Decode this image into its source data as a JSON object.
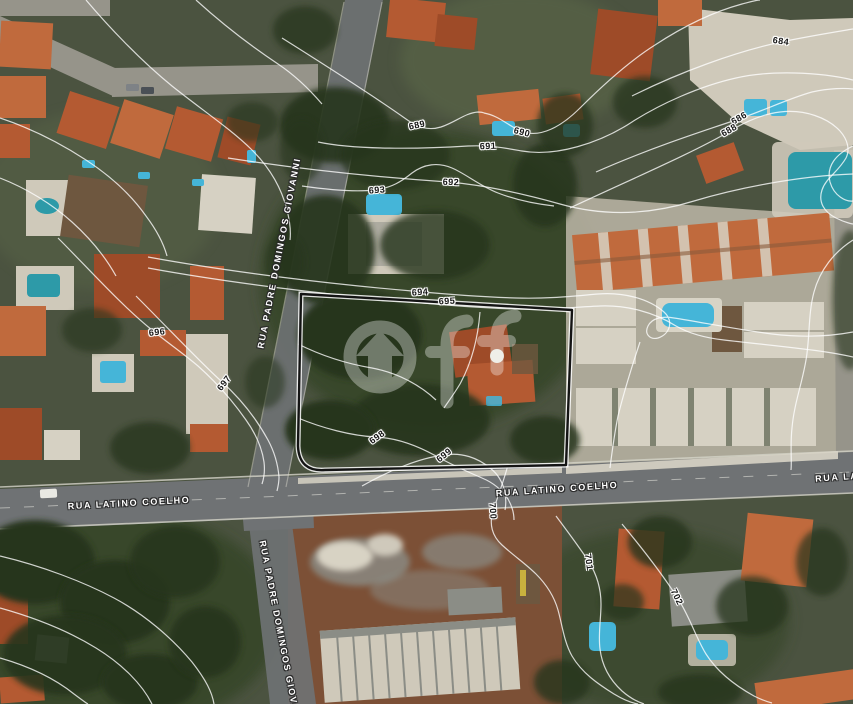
{
  "map": {
    "watermark": {
      "text": "OFF",
      "ff_text": "ff"
    },
    "street_labels": [
      {
        "id": "rua-padre-domingos-giovanni-north",
        "text": "RUA PADRE DOMINGOS GIOVANNI",
        "x": 279,
        "y": 253,
        "rotation": -79
      },
      {
        "id": "rua-padre-domingos-giovanni-south",
        "text": "RUA PADRE DOMINGOS GIOVANNI",
        "x": 281,
        "y": 636,
        "rotation": 79
      },
      {
        "id": "rua-latino-coelho-west",
        "text": "RUA LATINO COELHO",
        "x": 129,
        "y": 503,
        "rotation": -3
      },
      {
        "id": "rua-latino-coelho-east",
        "text": "RUA LATINO COELHO",
        "x": 557,
        "y": 489,
        "rotation": -4
      },
      {
        "id": "rua-latino-coelho-east-edge",
        "text": "RUA LAT",
        "x": 840,
        "y": 477,
        "rotation": -4
      }
    ],
    "contour_labels": [
      {
        "value": "684",
        "x": 781,
        "y": 41,
        "rotation": 8
      },
      {
        "value": "686",
        "x": 739,
        "y": 118,
        "rotation": -30
      },
      {
        "value": "688",
        "x": 729,
        "y": 130,
        "rotation": -30
      },
      {
        "value": "689",
        "x": 417,
        "y": 125,
        "rotation": -12
      },
      {
        "value": "690",
        "x": 522,
        "y": 132,
        "rotation": 14
      },
      {
        "value": "691",
        "x": 488,
        "y": 146,
        "rotation": -2
      },
      {
        "value": "692",
        "x": 451,
        "y": 182,
        "rotation": 2
      },
      {
        "value": "693",
        "x": 377,
        "y": 190,
        "rotation": -4
      },
      {
        "value": "694",
        "x": 420,
        "y": 292,
        "rotation": -4
      },
      {
        "value": "695",
        "x": 447,
        "y": 301,
        "rotation": -3
      },
      {
        "value": "696",
        "x": 157,
        "y": 332,
        "rotation": -6
      },
      {
        "value": "697",
        "x": 224,
        "y": 383,
        "rotation": -52
      },
      {
        "value": "698",
        "x": 377,
        "y": 437,
        "rotation": -36
      },
      {
        "value": "699",
        "x": 444,
        "y": 455,
        "rotation": -38
      },
      {
        "value": "700",
        "x": 493,
        "y": 511,
        "rotation": 86
      },
      {
        "value": "701",
        "x": 589,
        "y": 562,
        "rotation": 82
      },
      {
        "value": "702",
        "x": 677,
        "y": 597,
        "rotation": 64
      }
    ],
    "contour_lines": [
      {
        "d": "M632,96 C680,72 735,52 781,42 C810,36 835,32 853,29"
      },
      {
        "d": "M596,172 C650,148 706,130 739,119 C765,110 790,98 812,92 C830,88 845,88 853,89"
      },
      {
        "d": "M570,208 C625,182 695,152 730,131 C748,120 764,114 780,112 C805,109 828,118 840,131 C848,140 850,150 846,158 C838,172 826,178 822,190 C818,202 824,212 836,218 C846,223 853,224 853,224"
      },
      {
        "d": "M282,38 C320,62 368,92 406,119 C417,127 428,131 441,127 C456,122 465,113 478,112 C480,112 482,112 484,113"
      },
      {
        "d": "M484,113 C500,116 508,126 521,131 C540,139 562,126 580,108 C600,88 628,62 655,45 C690,22 720,10 742,4 C750,2 756,0 760,0"
      },
      {
        "d": "M318,142 C356,150 420,149 468,146 C490,145 505,148 522,151 C556,157 600,143 632,122 C660,104 700,86 736,78 C770,70 820,72 853,80"
      },
      {
        "d": "M228,158 C280,166 360,176 448,182 C486,185 524,194 560,204 C606,217 652,214 694,201 C734,189 796,176 853,174"
      },
      {
        "d": "M302,186 C330,190 356,192 374,190 C392,188 402,181 412,173 C424,164 438,162 452,168 C466,174 480,186 498,193 C516,200 536,204 554,206"
      },
      {
        "d": "M148,257 C230,272 330,284 412,291 C444,294 482,297 516,298 C548,299 574,296 598,294 C622,292 648,298 664,312 C674,321 670,334 658,338 C650,340 644,334 648,326 C652,318 662,316 674,318 C700,322 740,330 772,334 C805,338 832,336 853,332"
      },
      {
        "d": "M148,268 C230,283 330,295 412,302 C444,305 482,308 516,309 C548,310 576,307 600,306 C626,305 654,312 676,326 C690,334 706,338 724,340 C758,344 800,348 826,352 C840,354 848,356 853,357"
      },
      {
        "d": "M58,238 C88,268 122,306 152,330 C168,343 184,354 198,366 C216,382 232,400 246,420 C256,434 262,448 264,462 C265,470 264,478 262,484"
      },
      {
        "d": "M136,296 C168,328 200,362 221,381 C240,398 256,418 268,440 C275,453 278,465 279,477 C279,482 278,487 277,491"
      },
      {
        "d": "M298,418 C322,428 352,436 376,437 C398,438 418,446 436,456 C452,465 468,472 482,478 C494,483 502,490 508,499 C512,506 514,514 514,520"
      },
      {
        "d": "M362,486 C390,470 420,458 444,455 C462,452 478,458 490,468 C498,474 503,483 505,493 C506,499 506,505 505,510"
      },
      {
        "d": "M508,465 C504,480 498,496 493,511 C489,524 492,536 502,545 C514,556 526,564 536,574 C546,584 554,596 558,610 C562,624 564,642 572,656 C582,673 598,684 614,694 C624,700 632,703 638,704"
      },
      {
        "d": "M556,516 C568,532 580,548 589,562 C597,575 601,589 601,604 C601,620 598,634 600,649 C602,666 610,680 622,691 C630,698 638,702 644,704"
      },
      {
        "d": "M622,524 C642,548 662,574 677,597 C690,617 696,638 706,654 C718,673 736,686 754,696 C762,700 768,702 772,703"
      },
      {
        "d": "M0,556 C42,566 84,582 114,598 C144,614 172,638 192,662 C206,680 212,692 214,704"
      },
      {
        "d": "M0,608 C36,618 70,632 96,648 C122,664 142,684 152,704"
      },
      {
        "d": "M0,658 C28,666 54,678 74,694 C82,700 86,703 88,704"
      },
      {
        "d": "M86,0 C108,26 140,60 172,86 C202,110 232,130 252,150 C272,170 282,190 287,210 C290,222 291,232 290,240"
      },
      {
        "d": "M196,0 C218,20 248,44 278,64 C296,76 310,90 322,104"
      },
      {
        "d": "M0,118 C30,128 60,143 86,160 C112,177 132,196 146,216 C158,232 164,245 167,256"
      },
      {
        "d": "M0,178 C26,188 52,204 72,222 C92,240 106,258 116,276"
      },
      {
        "d": "M853,146 C836,154 826,166 830,182 C834,196 846,202 853,201"
      },
      {
        "d": "M853,240 C834,252 820,270 814,292 C808,314 810,338 806,360 C802,384 794,404 792,428 C790,446 792,460 791,470"
      },
      {
        "d": "M480,312 C478,338 472,362 460,384 C454,394 448,402 444,408"
      },
      {
        "d": "M298,344 C322,356 348,364 372,368 C398,373 420,385 436,400"
      },
      {
        "d": "M640,342 C632,366 624,392 618,416 C614,436 612,452 610,468"
      }
    ],
    "boundary": {
      "path": "M301,294 L572,310 L566,465 L325,470 Q299,472 298,446 L301,294 Z",
      "color": "#141414"
    },
    "colors": {
      "veg_base": "#4b5340",
      "veg_dark": "#27351f",
      "veg_mid": "#37462b",
      "road": "#6f7274",
      "road_light": "#96948a",
      "sidewalk": "#d8d4c6",
      "roof_orange": "#b45a32",
      "roof_orange2": "#c06a3d",
      "roof_deep": "#9e4b28",
      "roof_light": "#d6d1c3",
      "roof_dark": "#6e573f",
      "concrete": "#cfc9ba",
      "ground": "#b7b1a2",
      "dirt": "#7c5036",
      "pool": "#45b5d8",
      "pool_deep": "#2d9aa8",
      "contour": "#ffffff",
      "label_dark": "#161616"
    }
  }
}
